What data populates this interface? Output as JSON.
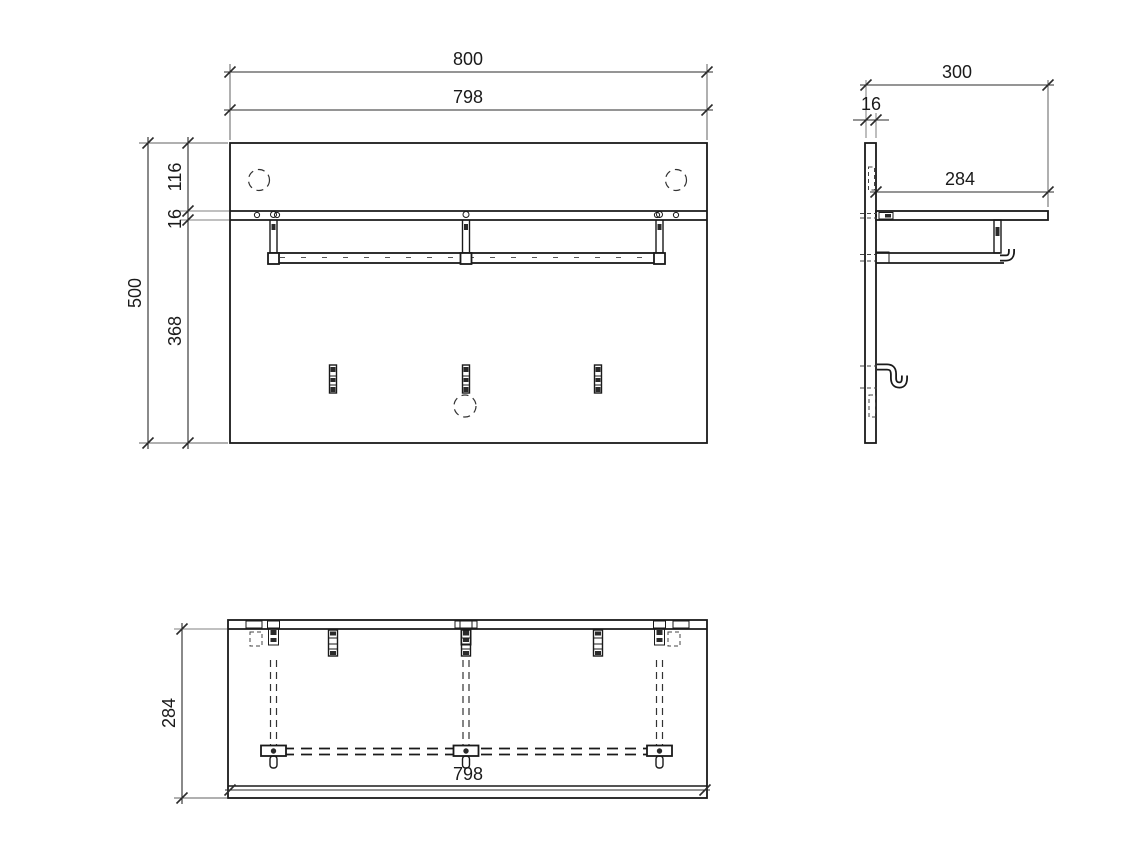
{
  "colors": {
    "line": "#1a1a1a",
    "dimension_text": "#1a1a1a",
    "extension_gray": "#9a9a9a",
    "background": "#ffffff"
  },
  "dimensions": {
    "front": {
      "overall_width": "800",
      "panel_width": "798",
      "top_offset": "116",
      "shelf_thickness": "16",
      "below_shelf": "368",
      "overall_height": "500"
    },
    "side": {
      "overall_depth": "300",
      "panel_thickness": "16",
      "shelf_depth": "284"
    },
    "plan": {
      "depth": "284",
      "inner_width": "798"
    }
  }
}
